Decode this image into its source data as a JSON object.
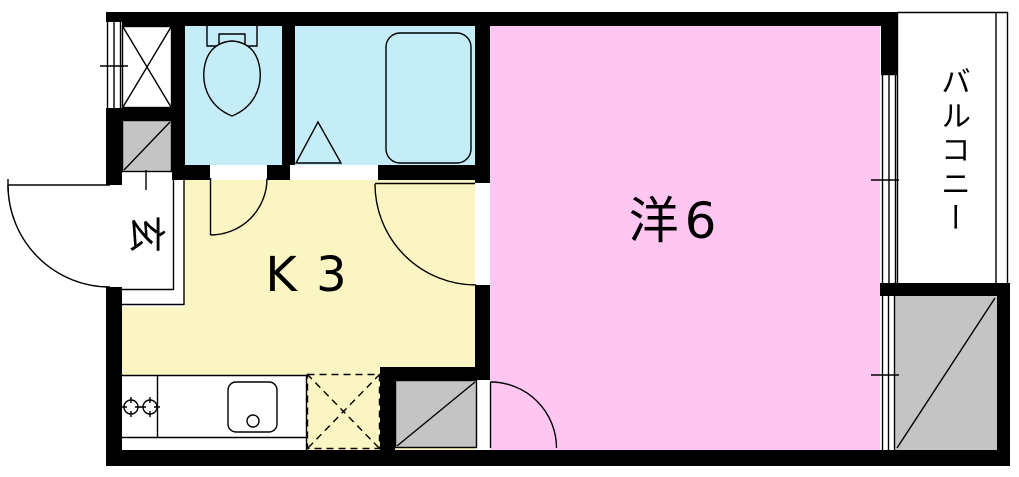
{
  "floorplan": {
    "rooms": {
      "kitchen": {
        "label": "K 3"
      },
      "western_room": {
        "label": "洋6"
      },
      "entrance": {
        "label": "玄"
      },
      "balcony": {
        "label": "バルコニー"
      }
    },
    "colors": {
      "wall": "#000000",
      "kitchen_floor": "#FBF5C3",
      "western_room_floor": "#FFC6F2",
      "wet_area_floor": "#C5EDF7",
      "service_gray": "#C4C4C4",
      "floor_white": "#FFFFFF",
      "line": "#000000"
    },
    "fixtures": {
      "toilet": "toilet-bowl-and-tank",
      "bathtub": "bathtub",
      "bath_door": "folding-door-triangle",
      "sink": "kitchen-sink",
      "stove": "two-burner-stove",
      "refrigerator_space": "dashed-cross-box",
      "pipe_shaft": "cross-box",
      "storage_spaces": "gray-diagonal-box",
      "doors": "quarter-circle-swing",
      "windows": "triple-line-window"
    }
  }
}
